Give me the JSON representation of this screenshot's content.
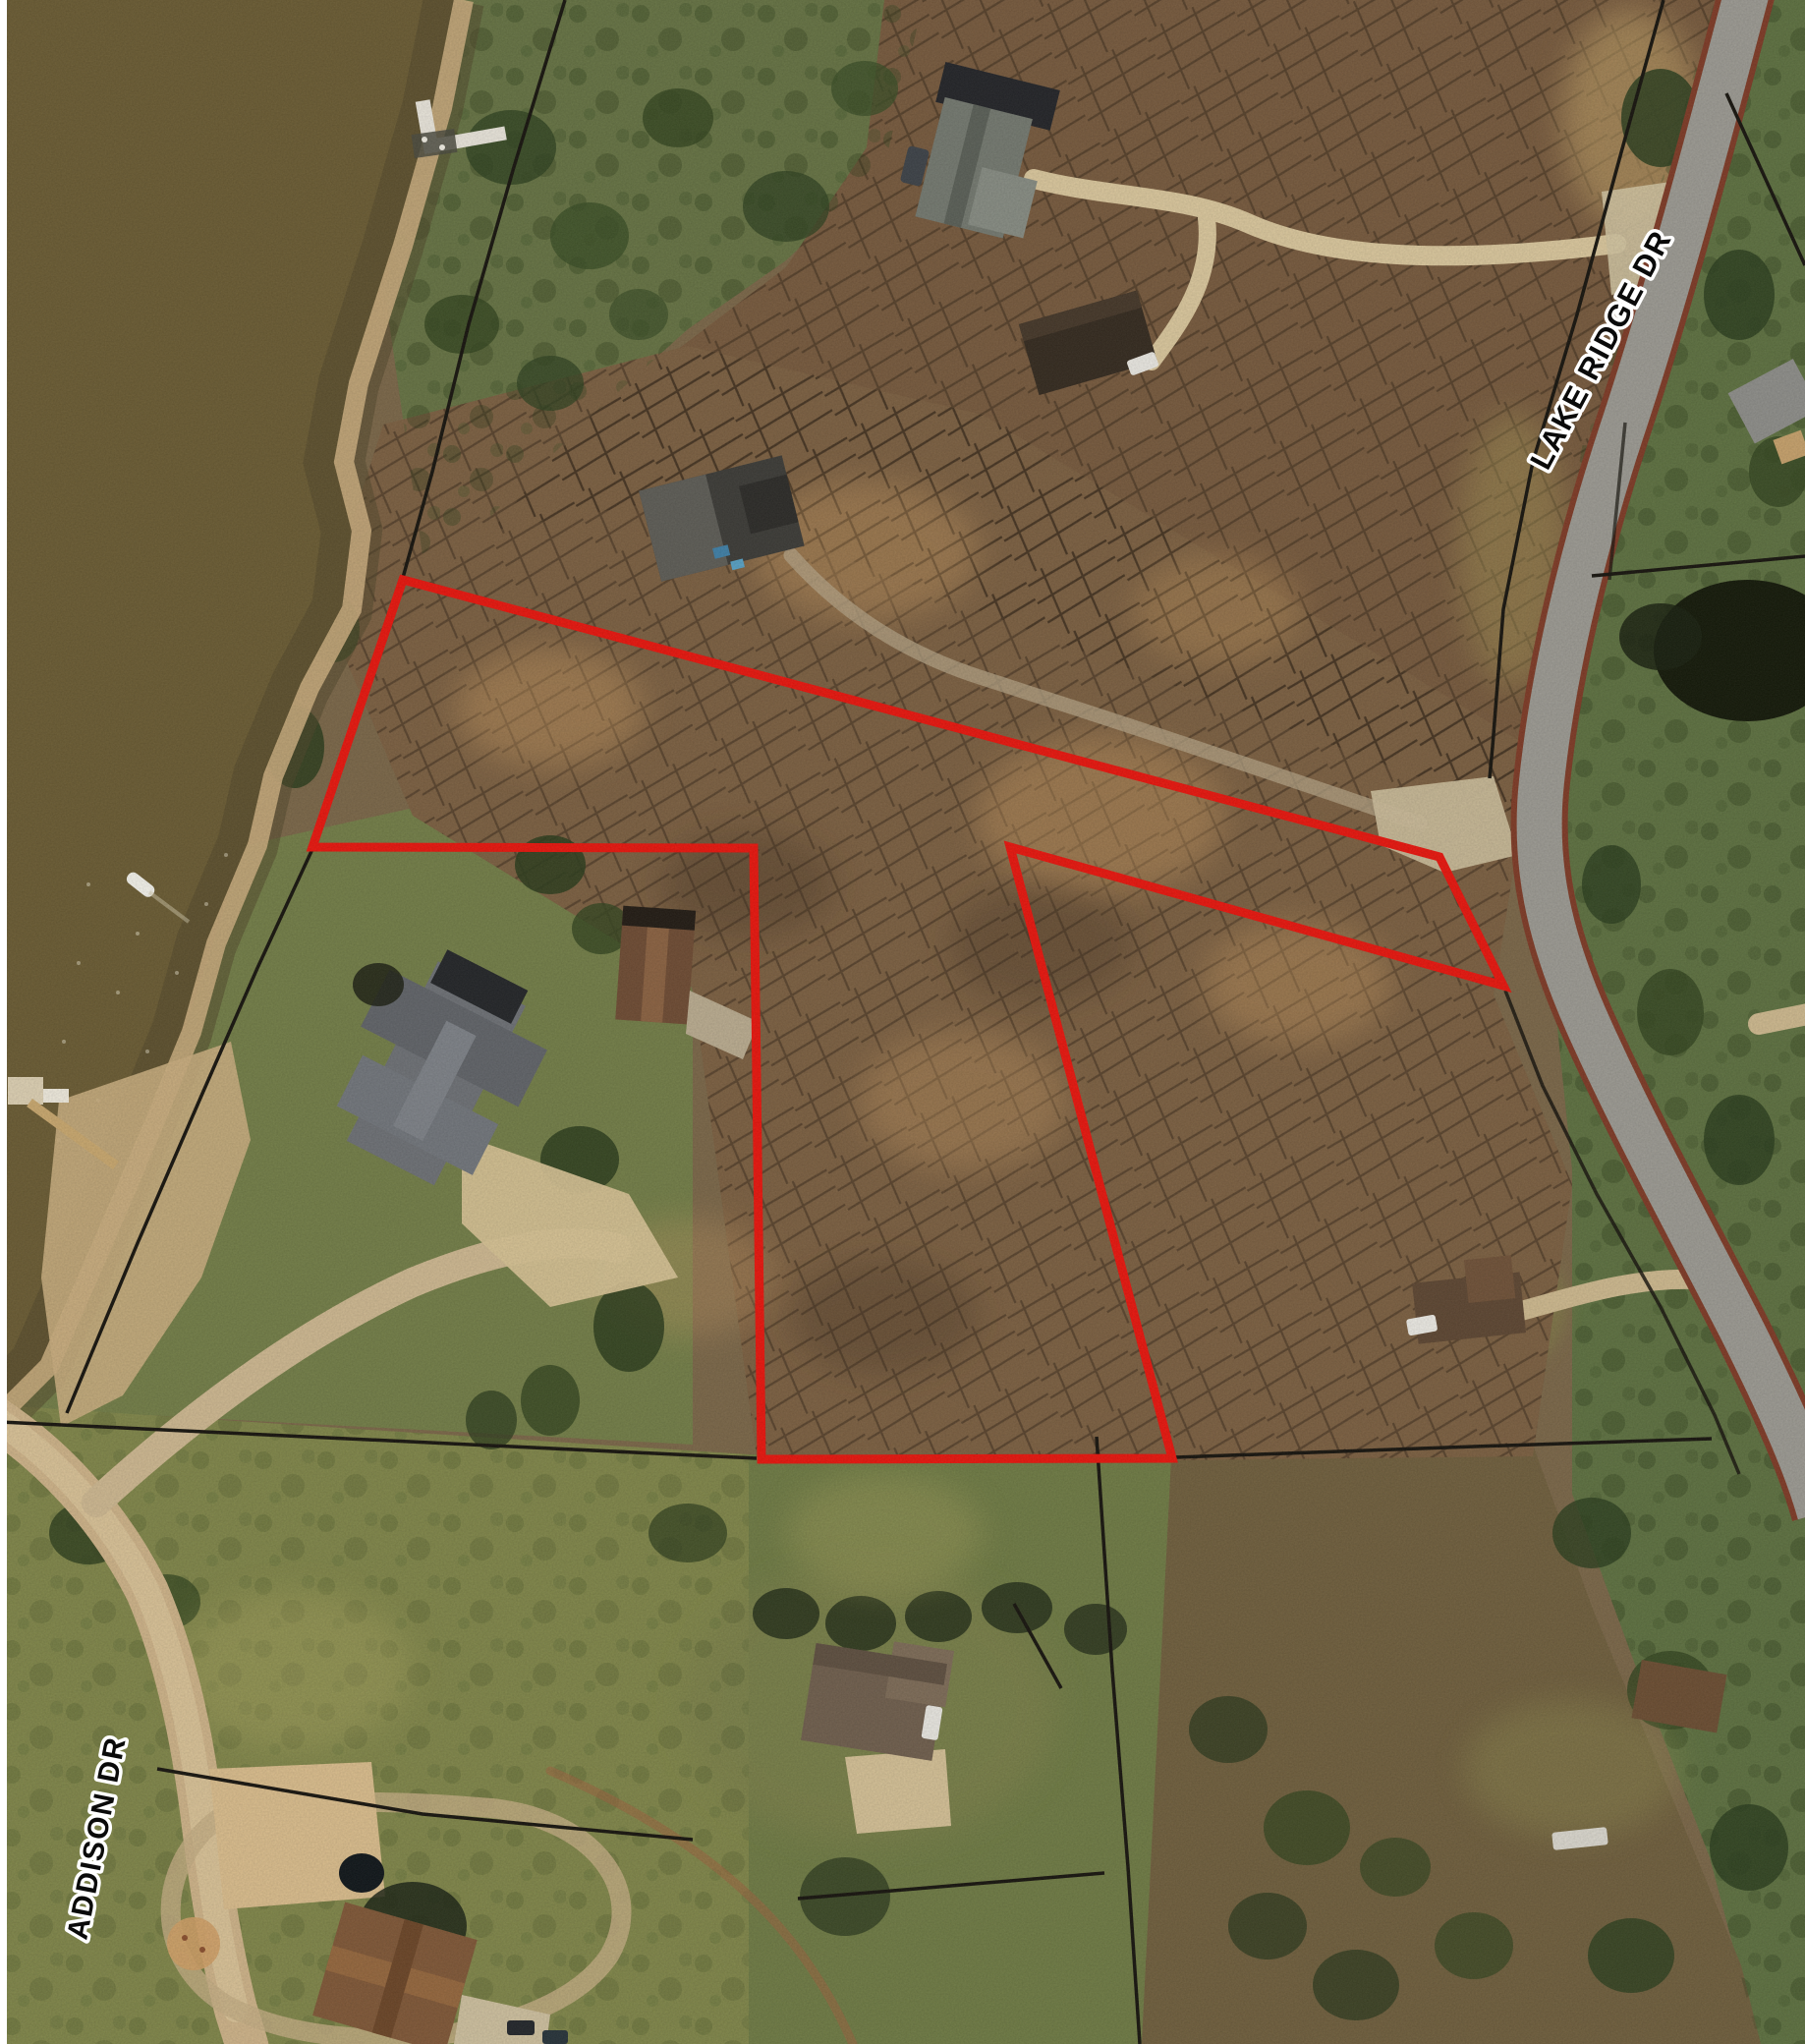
{
  "map": {
    "type": "aerial-parcel-map",
    "street_labels": [
      {
        "id": "road_1",
        "text": "LAKE RIDGE DR"
      },
      {
        "id": "road_2",
        "text": "ADDISON DR"
      }
    ],
    "boundary": {
      "feature": "subject-property-outline",
      "color": "#e8150d",
      "style": "solid"
    },
    "palette": {
      "water": "#6a5b33",
      "woods": "#7b5f41",
      "woods_top": "#76593d",
      "grass": "#6b7847",
      "field": "#7f8549",
      "road_asphalt": "#9b9992",
      "road_edge": "#7e3a26",
      "dirt_road": "#cdb288",
      "parcel_line": "#17140e",
      "label_fill": "#0a0a0a",
      "label_halo": "#ffffff"
    }
  }
}
